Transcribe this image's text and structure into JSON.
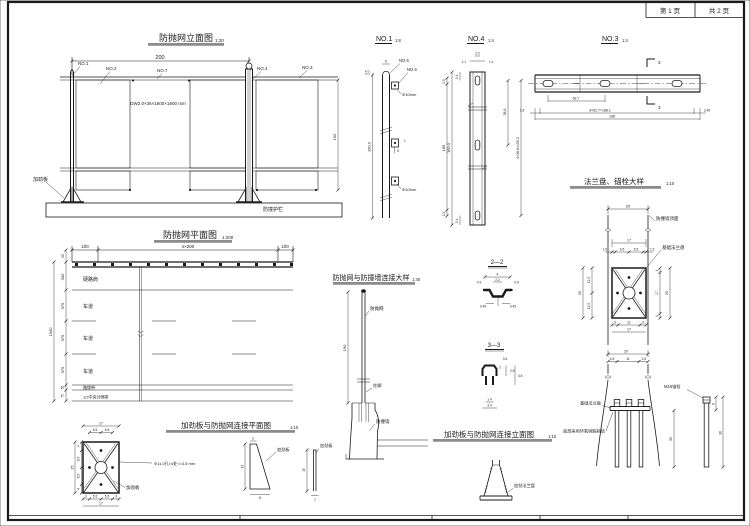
{
  "sheet": {
    "page_no": "第 1 页",
    "total_pages": "共 2 页"
  },
  "elevation": {
    "title": "防抛网立面图",
    "scale": "1:20",
    "dim_span": "200",
    "dim_height": "190",
    "no1": "NO.1",
    "no2": "NO.2",
    "no7": "NO.7",
    "no4": "NO.4",
    "no3": "NO.3",
    "mesh_spec": "DW2.0×36×1600×1900 mm",
    "stiffener": "加劲板",
    "guardrail": "防撞护栏"
  },
  "plan": {
    "title": "防抛网平面图",
    "scale": "1:200",
    "dim_left": "100",
    "dim_mid": "n×200",
    "dim_right": "100",
    "dim_offset": "25",
    "dim_total": "1500",
    "rows": [
      {
        "dim": "300",
        "label": "硬路肩"
      },
      {
        "dim": "375",
        "label": "车道"
      },
      {
        "dim": "375",
        "label": "车道"
      },
      {
        "dim": "375",
        "label": "车道"
      },
      {
        "dim": "50",
        "label": "路缘带"
      },
      {
        "dim": "75",
        "label": "1/2中央分隔带"
      }
    ]
  },
  "no1": {
    "title": "NO.1",
    "scale": "1:8",
    "no5": "NO.5",
    "no6": "NO.6",
    "hole": "Φ10mm",
    "dim_w": "6",
    "dim_cap": "3.5",
    "dim_h": "190.0",
    "dim_r_top": "2.5",
    "dim_r_mid": "185",
    "dim_1": "1",
    "dim_5": "5"
  },
  "no4": {
    "title": "NO.4",
    "scale": "1:4",
    "d22": "2.2",
    "d11": "1.1",
    "d24": "2.4",
    "dh": "160.0",
    "dseg": "38.8",
    "dtotal": "4×38.8=155.2"
  },
  "no3": {
    "title": "NO.3",
    "scale": "1:4",
    "sec": "3",
    "d627": "62.7",
    "dmid": "3×62.7=188.1",
    "dl": "1.6",
    "dr": "2.45",
    "dtot": "198"
  },
  "flange": {
    "title": "法兰盘、锚栓大样",
    "scale": "1:10",
    "wall_top": "防撞墙顶面",
    "base_plate": "基础法兰盘",
    "d20": "20",
    "d17": "17",
    "d15": "1.5",
    "d65": "6.5",
    "d25": "25",
    "d125": "12.5",
    "d4": "4",
    "d3": "3",
    "d11": "11"
  },
  "wallconn": {
    "title": "防抛网与防撞墙连接大样",
    "scale": "1:40",
    "net": "防抛网",
    "base": "柱脚",
    "wall": "防撞墙",
    "dh": "190"
  },
  "sec22": {
    "title": "2—2",
    "d4": "4",
    "d22": "2.2",
    "d09": "0.9",
    "d045": "0.45"
  },
  "sec33": {
    "title": "3—3",
    "d06": "0.6",
    "d25": "2.5",
    "d45": "4.5",
    "d14": "1.4",
    "d34": "3.4"
  },
  "stiffplan": {
    "title": "加劲板与防抛网连接平面图",
    "scale": "1:10",
    "note": "Φ11.0孔×4处 t=3.5 mm",
    "label": "加劲板",
    "d17": "17",
    "d65": "6.5",
    "d25": "25",
    "d4": "4",
    "d85": "8.5",
    "d3": "3",
    "d55": "5.5",
    "gusset_d3": "3",
    "gusset_d15": "15",
    "gusset_d8": "8",
    "plate_d15": "15",
    "plate_d1": "1"
  },
  "stiffelev": {
    "title": "加劲板与防抛网连接立面图",
    "scale": "1:10",
    "label": "加劲法兰盘"
  },
  "anchor": {
    "d20": "20",
    "d45": "4.5",
    "d11": "11",
    "plate_label": "基础法兰盘",
    "epoxy_note": "底部采用环氧树脂粘结",
    "bolt_label": "M16锚栓",
    "d30": "30",
    "d6": "6"
  }
}
